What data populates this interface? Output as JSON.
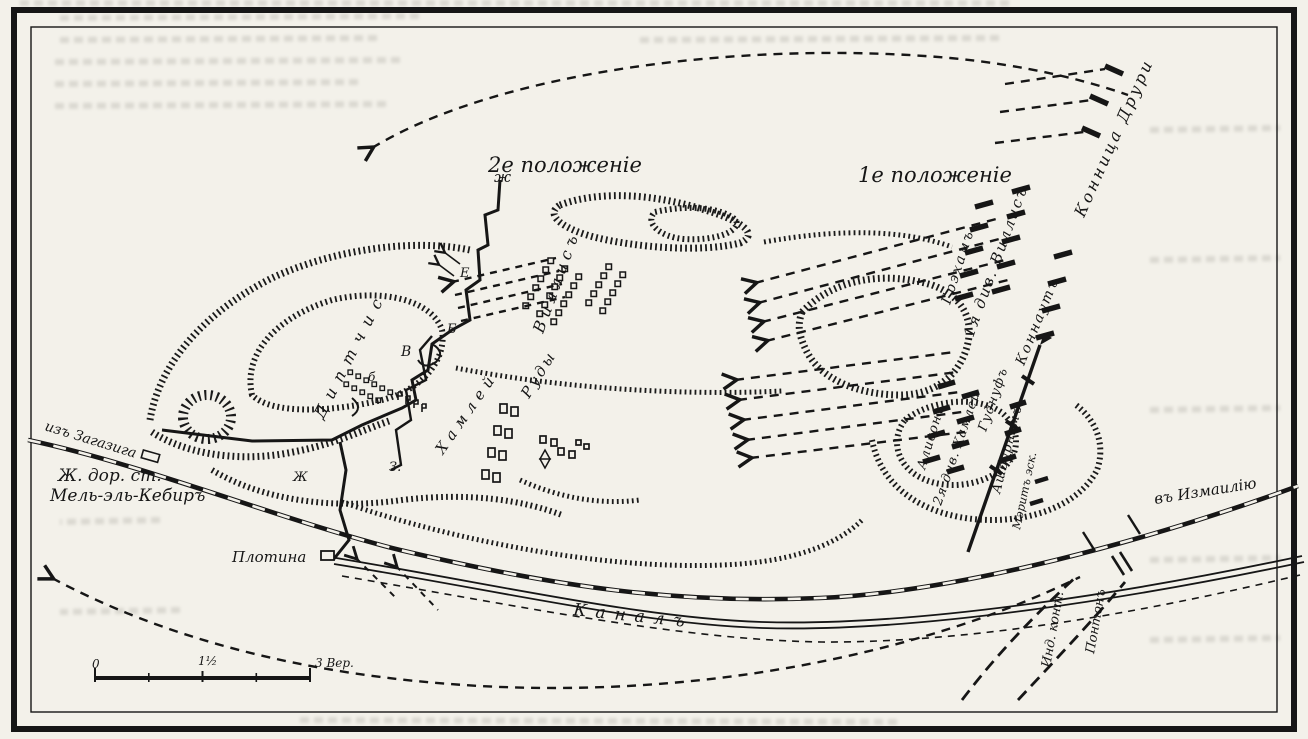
{
  "map": {
    "labels": {
      "position2": "2е положеніе",
      "position1": "1е положеніе",
      "drury": "Конница Друри",
      "graham": "Грэхамъ",
      "willis_div": "1я див. Виллисъ",
      "connaught": "Коннаутъ",
      "goodenough": "Гуднуфъ",
      "alison": "Алисонъ",
      "hamley_div": "2я див. Хамлей",
      "ashburnham": "Ашбурнэмъ",
      "merritt": "Мэритъ эск.",
      "willis_center": "Виллисъ",
      "rudy": "Руды",
      "hamley_center": "Хамлей",
      "trench_word": "Диптчис",
      "from_zagazig": "изъ Загазига",
      "station": "Ж. дор. ст.",
      "telelkebir": "Мель-эль-Кебиръ",
      "dam": "Плотина",
      "canal": "Каналъ",
      "to_ismailia": "въ Измаилію",
      "indian": "Инд. конт.",
      "pontoon": "Понтонъ"
    },
    "letter_markers": {
      "zh": "ж",
      "e": "Е",
      "b": "Б",
      "v": "В",
      "b2": "б",
      "z": "З.",
      "zh2": "Ж"
    },
    "scale": {
      "start": "0",
      "middle": "1½",
      "end": "3 Вер."
    },
    "colors": {
      "ink": "#161616",
      "paper": "#f3f1ea"
    }
  }
}
